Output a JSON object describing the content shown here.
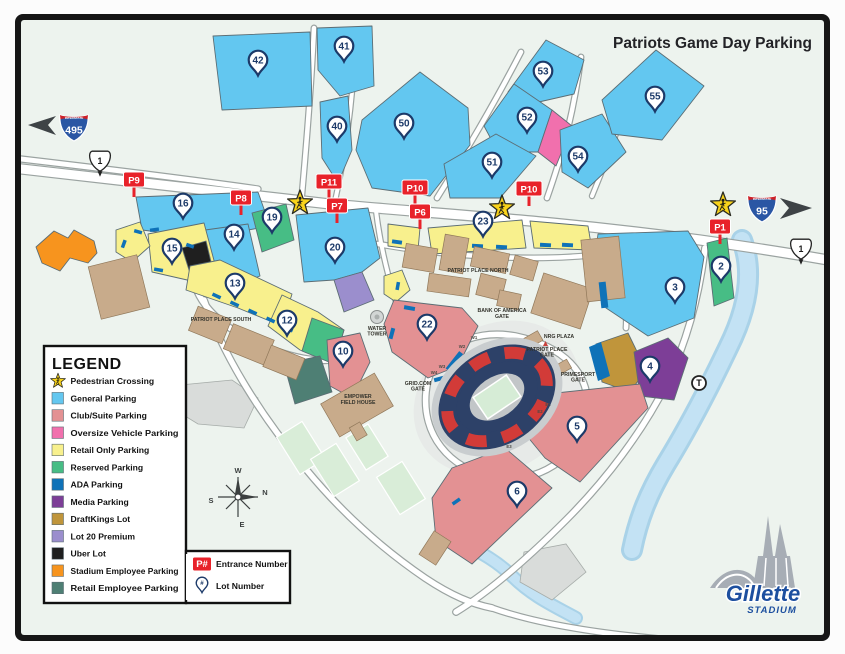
{
  "title": "Patriots Game Day Parking",
  "legend": {
    "title": "LEGEND",
    "items": [
      {
        "type": "star",
        "label": "Pedestrian Crossing",
        "color": "#f9d31b"
      },
      {
        "type": "swatch",
        "label": "General Parking",
        "color": "#63c7f0"
      },
      {
        "type": "swatch",
        "label": "Club/Suite Parking",
        "color": "#e39193"
      },
      {
        "type": "swatch",
        "label": "Oversize Vehicle Parking",
        "color": "#f170ad"
      },
      {
        "type": "swatch",
        "label": "Retail Only Parking",
        "color": "#f8f08d"
      },
      {
        "type": "swatch",
        "label": "Reserved Parking",
        "color": "#47bd85"
      },
      {
        "type": "swatch",
        "label": "ADA Parking",
        "color": "#0f72b8"
      },
      {
        "type": "swatch",
        "label": "Media Parking",
        "color": "#7d3e97"
      },
      {
        "type": "swatch",
        "label": "DraftKings Lot",
        "color": "#c0953b"
      },
      {
        "type": "swatch",
        "label": "Lot 20 Premium",
        "color": "#9b8ecd"
      },
      {
        "type": "swatch",
        "label": "Uber Lot",
        "color": "#1f1f1f"
      },
      {
        "type": "swatch",
        "label": "Stadium Employee Parking",
        "color": "#f7941e"
      },
      {
        "type": "swatch",
        "label": "Retail Employee Parking",
        "color": "#4e7f74"
      }
    ],
    "extra_items": [
      {
        "icon": "entrance-badge",
        "icon_label": "P#",
        "label": "Entrance Number"
      },
      {
        "icon": "lot-pin",
        "icon_label": "#",
        "label": "Lot Number"
      }
    ]
  },
  "map": {
    "lot_markers": [
      {
        "n": "42",
        "x": 258,
        "y": 60
      },
      {
        "n": "41",
        "x": 344,
        "y": 46
      },
      {
        "n": "40",
        "x": 337,
        "y": 126
      },
      {
        "n": "50",
        "x": 404,
        "y": 123
      },
      {
        "n": "51",
        "x": 492,
        "y": 162
      },
      {
        "n": "52",
        "x": 527,
        "y": 117
      },
      {
        "n": "53",
        "x": 543,
        "y": 71
      },
      {
        "n": "54",
        "x": 578,
        "y": 156
      },
      {
        "n": "55",
        "x": 655,
        "y": 96
      },
      {
        "n": "16",
        "x": 183,
        "y": 203
      },
      {
        "n": "19",
        "x": 272,
        "y": 217
      },
      {
        "n": "14",
        "x": 234,
        "y": 234
      },
      {
        "n": "15",
        "x": 172,
        "y": 248
      },
      {
        "n": "20",
        "x": 335,
        "y": 247
      },
      {
        "n": "23",
        "x": 483,
        "y": 221
      },
      {
        "n": "13",
        "x": 235,
        "y": 283
      },
      {
        "n": "12",
        "x": 287,
        "y": 320
      },
      {
        "n": "10",
        "x": 343,
        "y": 351
      },
      {
        "n": "22",
        "x": 427,
        "y": 324
      },
      {
        "n": "3",
        "x": 675,
        "y": 287
      },
      {
        "n": "2",
        "x": 721,
        "y": 266
      },
      {
        "n": "4",
        "x": 650,
        "y": 366
      },
      {
        "n": "5",
        "x": 577,
        "y": 426
      },
      {
        "n": "6",
        "x": 517,
        "y": 491
      }
    ],
    "entrance_markers": [
      {
        "n": "P9",
        "x": 134,
        "y": 180
      },
      {
        "n": "P8",
        "x": 241,
        "y": 198
      },
      {
        "n": "P11",
        "x": 329,
        "y": 182
      },
      {
        "n": "P7",
        "x": 337,
        "y": 206
      },
      {
        "n": "P10",
        "x": 415,
        "y": 188
      },
      {
        "n": "P6",
        "x": 420,
        "y": 212
      },
      {
        "n": "P10",
        "x": 529,
        "y": 189
      },
      {
        "n": "P1",
        "x": 720,
        "y": 227
      }
    ],
    "pedestrian_crossings": [
      {
        "x": 300,
        "y": 203
      },
      {
        "x": 502,
        "y": 208
      },
      {
        "x": 723,
        "y": 205
      }
    ],
    "labels": [
      {
        "lines": [
          "PATRIOT PLACE NORTH"
        ],
        "x": 478,
        "y": 272,
        "size": 5.2
      },
      {
        "lines": [
          "PATRIOT PLACE SOUTH"
        ],
        "x": 221,
        "y": 321,
        "size": 5.2
      },
      {
        "lines": [
          "WATER",
          "TOWER"
        ],
        "x": 377,
        "y": 330,
        "size": 4.6
      },
      {
        "lines": [
          "EMPOWER",
          "FIELD HOUSE"
        ],
        "x": 358,
        "y": 398,
        "size": 5
      },
      {
        "lines": [
          "BANK OF AMERICA",
          "GATE"
        ],
        "x": 502,
        "y": 312,
        "size": 5
      },
      {
        "lines": [
          "NRG PLAZA"
        ],
        "x": 559,
        "y": 338,
        "size": 4.8
      },
      {
        "lines": [
          "PATRIOT PLACE",
          "GATE"
        ],
        "x": 547,
        "y": 351,
        "size": 4.6
      },
      {
        "lines": [
          "PRIMESPORT",
          "GATE"
        ],
        "x": 578,
        "y": 376,
        "size": 4.6
      },
      {
        "lines": [
          "GRID.COM",
          "GATE"
        ],
        "x": 418,
        "y": 385,
        "size": 4.6
      }
    ],
    "gate_labels": [
      {
        "text": "W1",
        "x": 474,
        "y": 339
      },
      {
        "text": "W2",
        "x": 462,
        "y": 348
      },
      {
        "text": "W3",
        "x": 442,
        "y": 368
      },
      {
        "text": "W4",
        "x": 434,
        "y": 374
      },
      {
        "text": "E1",
        "x": 548,
        "y": 406
      },
      {
        "text": "E2",
        "x": 540,
        "y": 413
      },
      {
        "text": "E3",
        "x": 509,
        "y": 448
      }
    ],
    "shields": {
      "i495": {
        "system": "INTERSTATE",
        "number": "495"
      },
      "i95": {
        "system": "INTERSTATE",
        "number": "95"
      },
      "us1": {
        "number": "1"
      }
    },
    "transit_marker": "T",
    "compass": {
      "top": "W",
      "right": "N",
      "left": "S",
      "bottom": "E"
    }
  },
  "logo": {
    "brand": "Gillette",
    "sub": "STADIUM"
  }
}
